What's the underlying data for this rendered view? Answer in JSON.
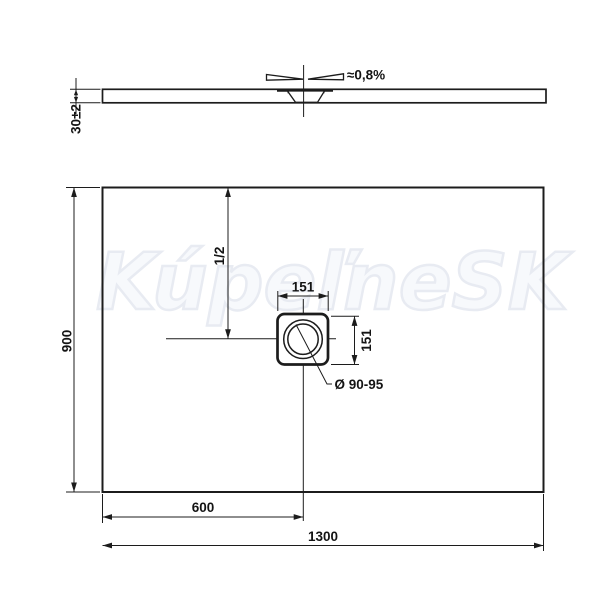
{
  "watermark": {
    "text": "KúpeľneSK"
  },
  "side_view": {
    "thickness_dim": "30±2",
    "slope_label": "≈0,8%"
  },
  "plan_view": {
    "height_dim": "900",
    "half_label": "1/2",
    "drain_width_dim": "151",
    "drain_depth_dim": "151",
    "drain_diameter_label": "Ø 90-95",
    "drain_offset_dim": "600",
    "length_dim": "1300"
  },
  "colors": {
    "line": "#1c1c1c",
    "text": "#141414",
    "watermark": "#e8ebf2"
  }
}
